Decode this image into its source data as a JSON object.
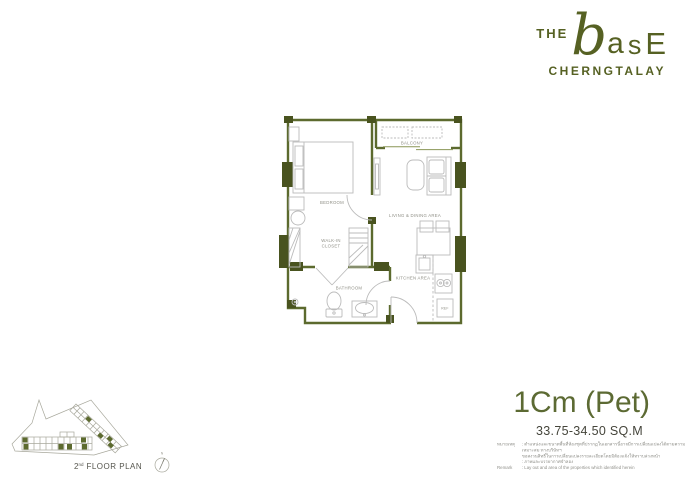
{
  "brand": {
    "the": "THE",
    "b": "b",
    "a": "a",
    "s": "s",
    "e": "E",
    "location": "CHERNGTALAY"
  },
  "plan_labels": {
    "bedroom": "BEDROOM",
    "balcony": "BALCONY",
    "living": "LIVING & DINING AREA",
    "walkin_1": "WALK-IN",
    "walkin_2": "CLOSET",
    "bathroom": "BATHROOM",
    "kitchen": "KITCHEN AREA",
    "ref": "REF"
  },
  "site": {
    "floor_num": "2",
    "floor_sup": "nd",
    "floor_label": "FLOOR PLAN",
    "compass": "N"
  },
  "unit": {
    "name": "1Cm (Pet)",
    "area": "33.75-34.50 SQ.M"
  },
  "remark": {
    "th_label": "หมายเหตุ",
    "th_line1": ": ตำแหน่งและขนาดพื้นที่ห้องชุดที่ปรากฏในเอกสารนี้อาจมีการเปลี่ยนแปลงได้ตามความเหมาะสม ทางบริษัทฯ",
    "th_line2": "ขอสงวนสิทธิ์ในการเปลี่ยนแปลงรายละเอียดโดยมิต้องแจ้งให้ทราบล่วงหน้า",
    "th_line3": ": ภาพและบรรยากาศจำลอง",
    "en_label": "Remark",
    "en_line": ": Lay out and area of the properties which identified herein"
  },
  "colors": {
    "wall_olive": "#5c6a2e",
    "column_dark": "#49531f",
    "logo_green": "#566123",
    "furniture_gray": "#bbbbbb",
    "label_gray": "#8f8f86",
    "unit_name_green": "#5c6a33"
  }
}
